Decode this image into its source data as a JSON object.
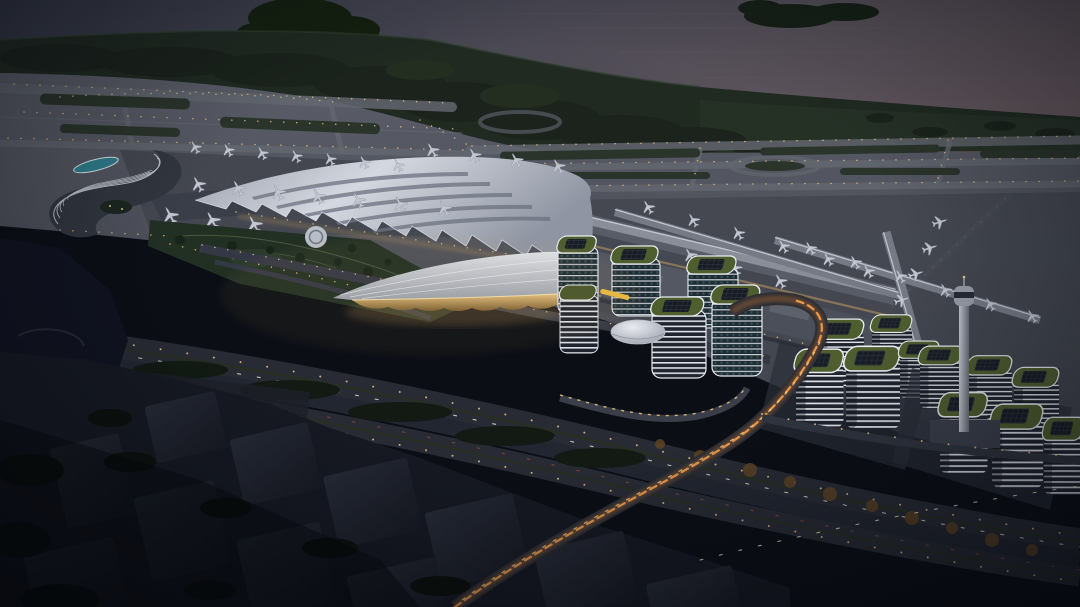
{
  "scene": {
    "title": "Coastal airport masterplan — aerial rendering at dusk",
    "description": "Night-time bird's-eye architectural visualization: waterfront runways with parked aircraft, a swept-wing terminal, shell-roof transport centre, curved hotel with rooftop pool, office park with dome hall, two white residential clusters, control tower, light-trail highways and a dark unlit city foreground.",
    "time_of_day": "dusk"
  },
  "palette": {
    "water": "#42444f",
    "water_warm": "#6b5a5e",
    "shore_forest": "#1b231c",
    "grass_hill": "#273227",
    "airfield": "#53565f",
    "apron": "#43464f",
    "taxiway": "#63666f",
    "infield_green": "#2b342b",
    "runway_light": "#e8c77e",
    "terminal_roof": "#c6cad3",
    "concourse": "#7d818c",
    "glow_amber": "#d3a868",
    "glass_teal": "#24323a",
    "facade_band": "#d9dde2",
    "roof_garden": "#4f5e2f",
    "pool_teal": "#2f7e8d",
    "road": "#282b34",
    "trail_orange": "#f19c4a",
    "trail_white": "#efe7d2",
    "foreground": "#161922",
    "night_shadow": "#0b0e15"
  },
  "inventory": {
    "airplanes_parked": 42,
    "terminals": 2,
    "concourse_piers": 3,
    "hotel": "curved podium hotel with teal rooftop pool",
    "transport_centre": "shell-roof hall with amber glowing glass",
    "office_buildings": 6,
    "dome_hall": 1,
    "residential_clusters": 2,
    "residential_buildings": 11,
    "control_tower": 1,
    "helipad": 1,
    "island": 1
  }
}
